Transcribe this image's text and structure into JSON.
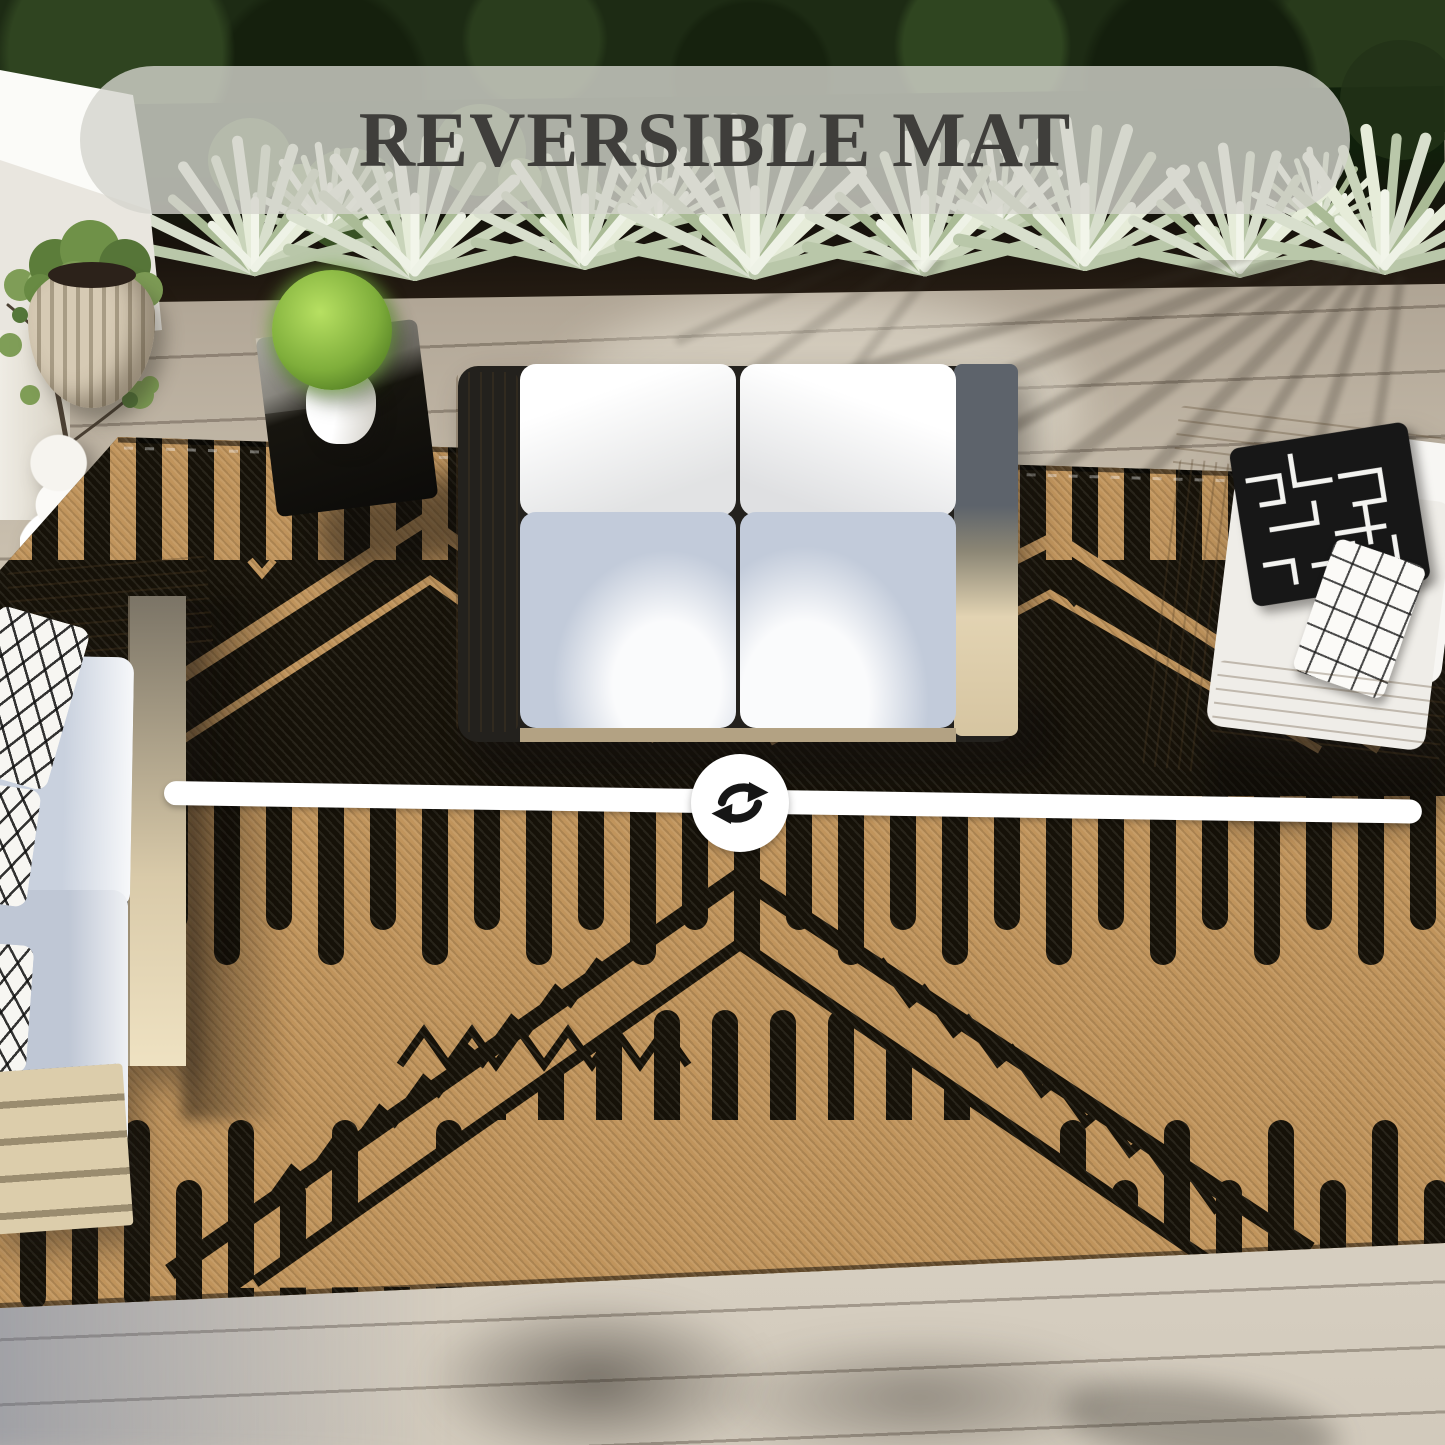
{
  "banner": {
    "title": "REVERSIBLE MAT",
    "background": "rgba(213,213,205,0.8)",
    "text_color": "#3f3e3b"
  },
  "divider": {
    "icon": "swap-arrows-icon",
    "line_color": "#ffffff",
    "icon_bg": "#ffffff",
    "arrow_color": "#161616"
  },
  "rug": {
    "name": "reversible outdoor mat",
    "side_a": {
      "label": "black side up",
      "base": "#161209",
      "accent": "#c0945c"
    },
    "side_b": {
      "label": "camel side up",
      "base": "#c0945c",
      "accent": "#161209"
    }
  },
  "palette": {
    "hedge": "#1d2b14",
    "agave": "#c9d4ba",
    "soil": "#17120c",
    "deck_shaded": "#8f867b",
    "deck_sunlit": "#d8d0c2",
    "wall": "#f2efe8",
    "wood_frame": "#dcc9a4",
    "seat_cushion": "#c3ccdb",
    "back_cushion": "#f3f2ef"
  },
  "scene": {
    "items": [
      "hedge",
      "agave-plants",
      "white-wall",
      "potted-tree",
      "ribbed-planter",
      "sculpted-vase",
      "ball-topiary",
      "black-side-table",
      "left-sofa",
      "center-loveseat",
      "right-armchair",
      "reversible-rug",
      "wood-deck"
    ]
  }
}
